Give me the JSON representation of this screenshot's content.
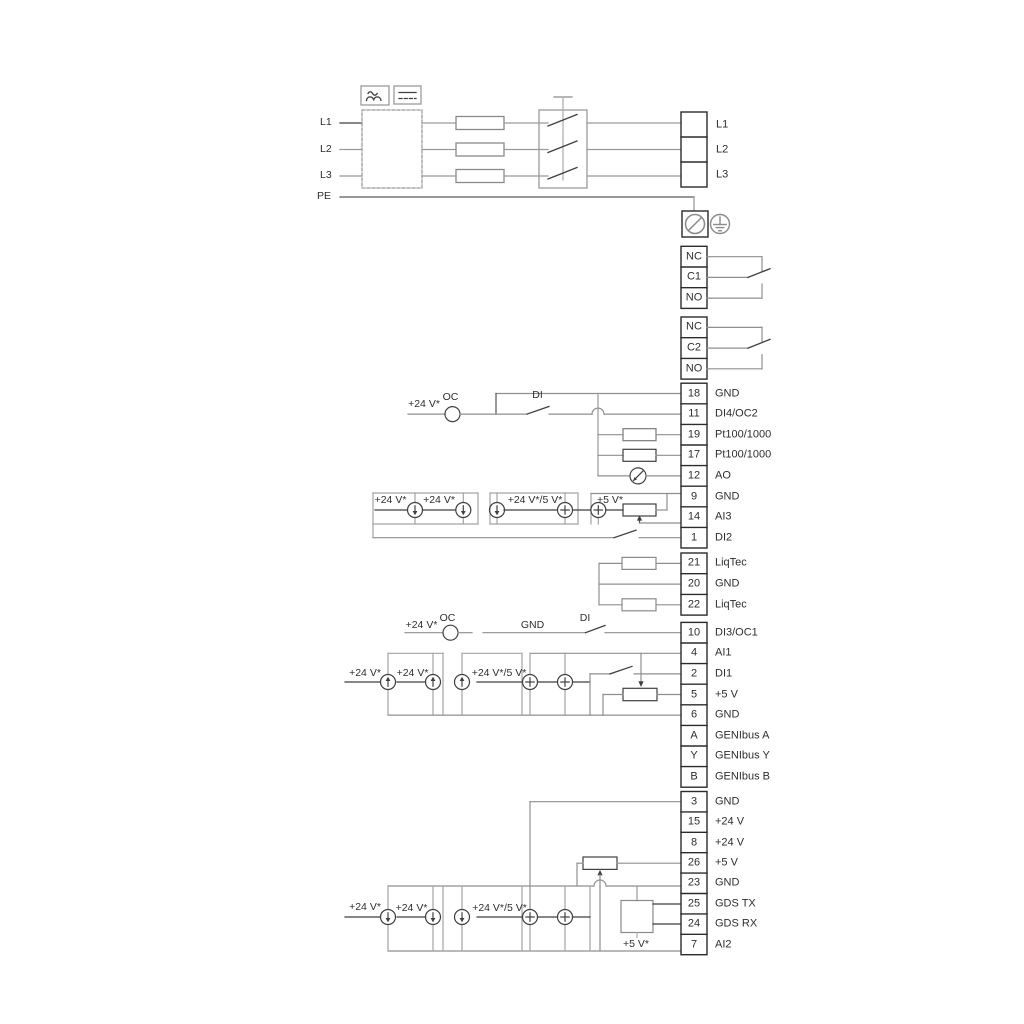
{
  "power_in": {
    "l1": "L1",
    "l2": "L2",
    "l3": "L3",
    "pe": "PE"
  },
  "power_out": {
    "l1": "L1",
    "l2": "L2",
    "l3": "L3"
  },
  "relay1": {
    "nc": "NC",
    "c": "C1",
    "no": "NO"
  },
  "relay2": {
    "nc": "NC",
    "c": "C2",
    "no": "NO"
  },
  "strip1": [
    {
      "num": "18",
      "label": "GND"
    },
    {
      "num": "11",
      "label": "DI4/OC2"
    },
    {
      "num": "19",
      "label": "Pt100/1000"
    },
    {
      "num": "17",
      "label": "Pt100/1000"
    },
    {
      "num": "12",
      "label": "AO"
    },
    {
      "num": "9",
      "label": "GND"
    },
    {
      "num": "14",
      "label": "AI3"
    },
    {
      "num": "1",
      "label": "DI2"
    }
  ],
  "liqtec": [
    {
      "num": "21",
      "label": "LiqTec"
    },
    {
      "num": "20",
      "label": "GND"
    },
    {
      "num": "22",
      "label": "LiqTec"
    }
  ],
  "strip2": [
    {
      "num": "10",
      "label": "DI3/OC1"
    },
    {
      "num": "4",
      "label": "AI1"
    },
    {
      "num": "2",
      "label": "DI1"
    },
    {
      "num": "5",
      "label": "+5 V"
    },
    {
      "num": "6",
      "label": "GND"
    },
    {
      "num": "A",
      "label": "GENIbus A"
    },
    {
      "num": "Y",
      "label": "GENIbus Y"
    },
    {
      "num": "B",
      "label": "GENIbus B"
    }
  ],
  "strip3": [
    {
      "num": "3",
      "label": "GND"
    },
    {
      "num": "15",
      "label": "+24 V"
    },
    {
      "num": "8",
      "label": "+24 V"
    },
    {
      "num": "26",
      "label": "+5 V"
    },
    {
      "num": "23",
      "label": "GND"
    },
    {
      "num": "25",
      "label": "GDS TX"
    },
    {
      "num": "24",
      "label": "GDS RX"
    },
    {
      "num": "7",
      "label": "AI2"
    }
  ],
  "ann": {
    "row1_v24": "+24 V*",
    "row1_oc": "OC",
    "row1_di": "DI",
    "s1a": "+24 V*",
    "s1b": "+24 V*",
    "s1c": "+24 V*/5 V*",
    "s1d": "+5 V*",
    "row2_v24": "+24 V*",
    "row2_oc": "OC",
    "row2_gnd": "GND",
    "row2_di": "DI",
    "s2a": "+24 V*",
    "s2b": "+24 V*",
    "s2c": "+24 V*/5 V*",
    "s3a": "+24 V*",
    "s3b": "+24 V*",
    "s3c": "+24 V*/5 V*",
    "s3d": "+5 V*"
  },
  "colors": {
    "wire": "#8f8f8f",
    "symbol": "#3f3f3f",
    "terminal": "#2b2b2b",
    "rail": "#a3a3a3"
  }
}
